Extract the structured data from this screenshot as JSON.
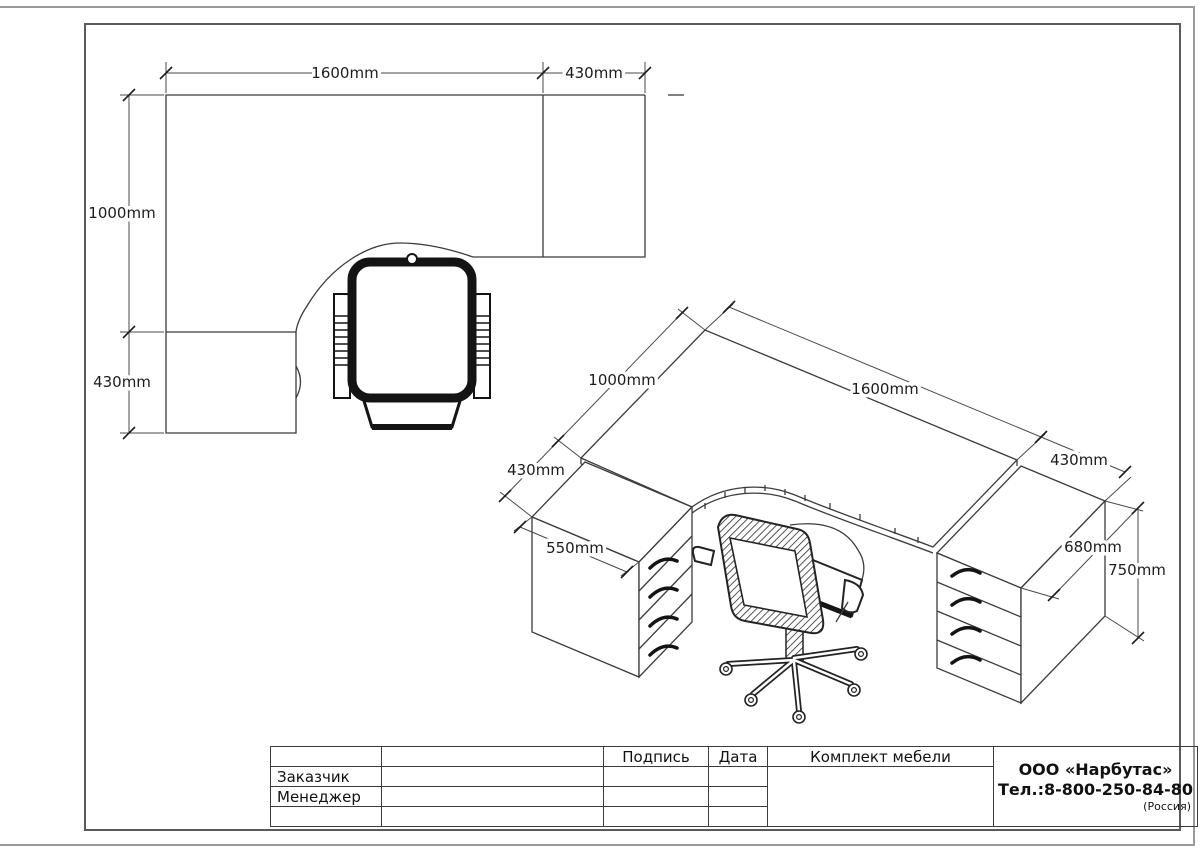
{
  "doc_title": "Комплект мебели",
  "plan": {
    "dim_width": "1600mm",
    "dim_right_pedestal": "430mm",
    "dim_depth": "1000mm",
    "dim_left_pedestal": "430mm"
  },
  "iso": {
    "dim_depth": "1000mm",
    "dim_width": "1600mm",
    "dim_right_pedestal": "430mm",
    "dim_left_front": "430mm",
    "dim_left_pedestal_width": "550mm",
    "dim_right_pedestal_depth": "680mm",
    "dim_height": "750mm"
  },
  "title_block": {
    "headers": {
      "signature": "Подпись",
      "date": "Дата",
      "set": "Комплект мебели"
    },
    "rows": [
      {
        "label": "Заказчик"
      },
      {
        "label": "Менеджер"
      }
    ],
    "company": {
      "name": "ООО «Нарбутас»",
      "phone": "Тел.:8-800-250-84-80",
      "country": "(Россия)"
    }
  },
  "colors": {
    "background": "#ffffff",
    "drawing_line": "#3b3b3b",
    "dimension_text": "#1c1c1c",
    "border_outer": "#9a9a9a",
    "border_inner": "#5a5a5a"
  }
}
